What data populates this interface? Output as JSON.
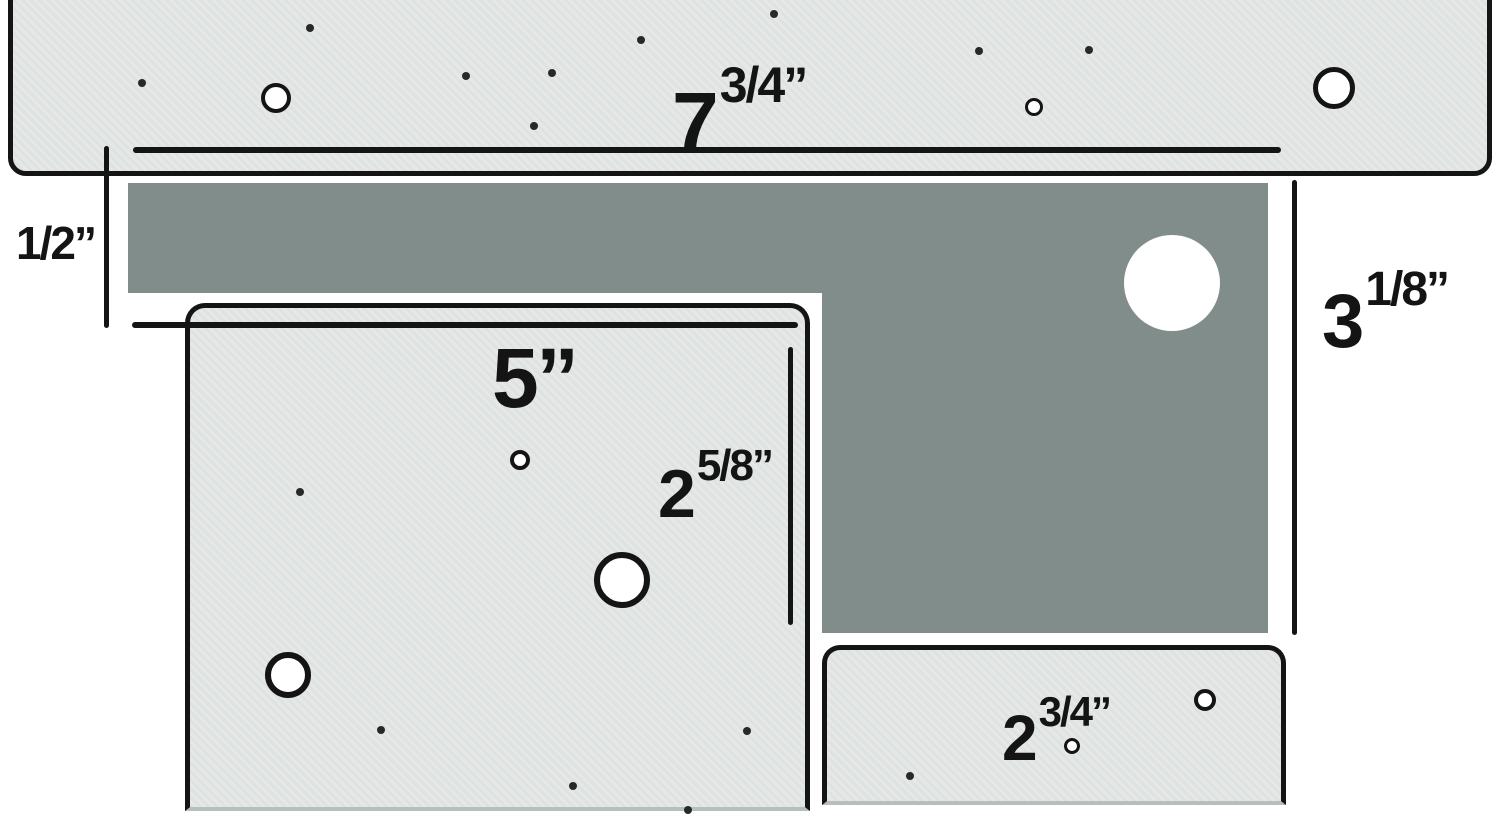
{
  "colors": {
    "background": "#ffffff",
    "plate_fill": "#e5e8e7",
    "back_plate_fill": "#818d8b",
    "line_color": "#141414"
  },
  "measurements": {
    "top_plate_width": {
      "whole": "7",
      "fraction": "3/4”"
    },
    "vertical_gap": {
      "whole": "1/2”",
      "fraction": ""
    },
    "left_plate_width": {
      "whole": "5’’",
      "fraction": ""
    },
    "left_plate_height": {
      "whole": "2",
      "fraction": "5/8”"
    },
    "right_column_height": {
      "whole": "3",
      "fraction": "1/8”"
    },
    "bottom_plate_width": {
      "whole": "2",
      "fraction": "3/4”"
    }
  },
  "holes": {
    "top_plate": [
      {
        "x": 276,
        "y": 98,
        "r": 15,
        "ring": 4
      },
      {
        "x": 1334,
        "y": 88,
        "r": 21,
        "ring": 5
      },
      {
        "x": 1034,
        "y": 107,
        "r": 9,
        "ring": 3
      }
    ],
    "left_plate": [
      {
        "x": 288,
        "y": 675,
        "r": 23,
        "ring": 6
      },
      {
        "x": 622,
        "y": 580,
        "r": 28,
        "ring": 6
      },
      {
        "x": 520,
        "y": 460,
        "r": 10,
        "ring": 4
      }
    ],
    "bottom_plate": [
      {
        "x": 1205,
        "y": 700,
        "r": 11,
        "ring": 4
      },
      {
        "x": 1072,
        "y": 746,
        "r": 8,
        "ring": 3
      }
    ],
    "gray_region": [
      {
        "x": 1172,
        "y": 283,
        "r": 48,
        "ring": 0
      }
    ]
  },
  "dots": [
    [
      142,
      83
    ],
    [
      310,
      28
    ],
    [
      466,
      76
    ],
    [
      552,
      73
    ],
    [
      641,
      40
    ],
    [
      534,
      126
    ],
    [
      774,
      14
    ],
    [
      979,
      51
    ],
    [
      1089,
      50
    ],
    [
      300,
      492
    ],
    [
      381,
      730
    ],
    [
      573,
      786
    ],
    [
      747,
      731
    ],
    [
      688,
      810
    ],
    [
      910,
      776
    ]
  ]
}
